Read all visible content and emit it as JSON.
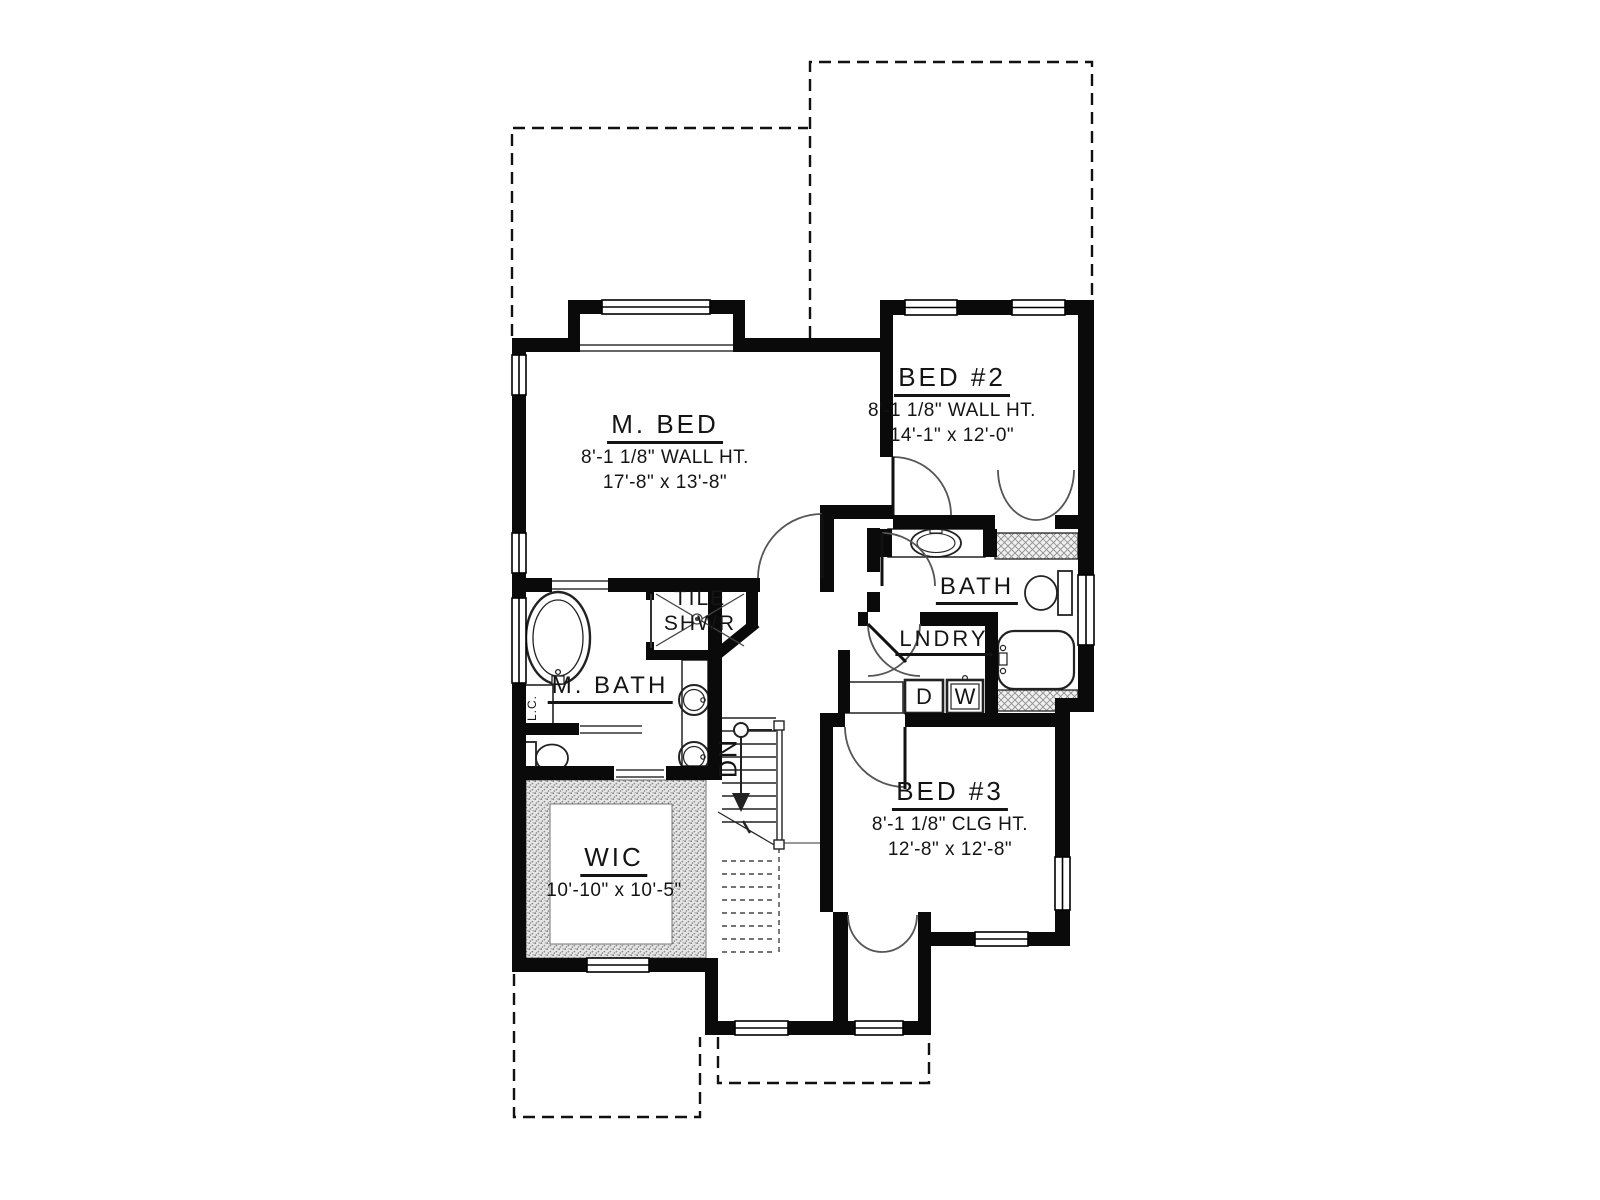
{
  "plan": {
    "type": "second-floor-plan",
    "rooms": {
      "m_bed": {
        "name": "M. BED",
        "wall_ht": "8'-1 1/8\" WALL HT.",
        "size": "17'-8\" x 13'-8\""
      },
      "bed2": {
        "name": "BED #2",
        "wall_ht": "8'-1 1/8\" WALL HT.",
        "size": "14'-1\" x 12'-0\""
      },
      "bed3": {
        "name": "BED #3",
        "wall_ht": "8'-1 1/8\" CLG HT.",
        "size": "12'-8\" x 12'-8\""
      },
      "wic": {
        "name": "WIC",
        "size": "10'-10\" x 10'-5\""
      },
      "m_bath": {
        "name": "M. BATH"
      },
      "bath": {
        "name": "BATH"
      },
      "lndry": {
        "name": "LNDRY"
      },
      "tile_shwr": {
        "line1": "TILE",
        "line2": "SHWR"
      }
    },
    "annotations": {
      "stairs_down": "DN",
      "dryer": "D",
      "washer": "W",
      "linen_closet": "L.C."
    },
    "colors": {
      "walls": "#0a0a0a",
      "background": "#ffffff",
      "hatch_gray": "#9a9a9a"
    }
  }
}
